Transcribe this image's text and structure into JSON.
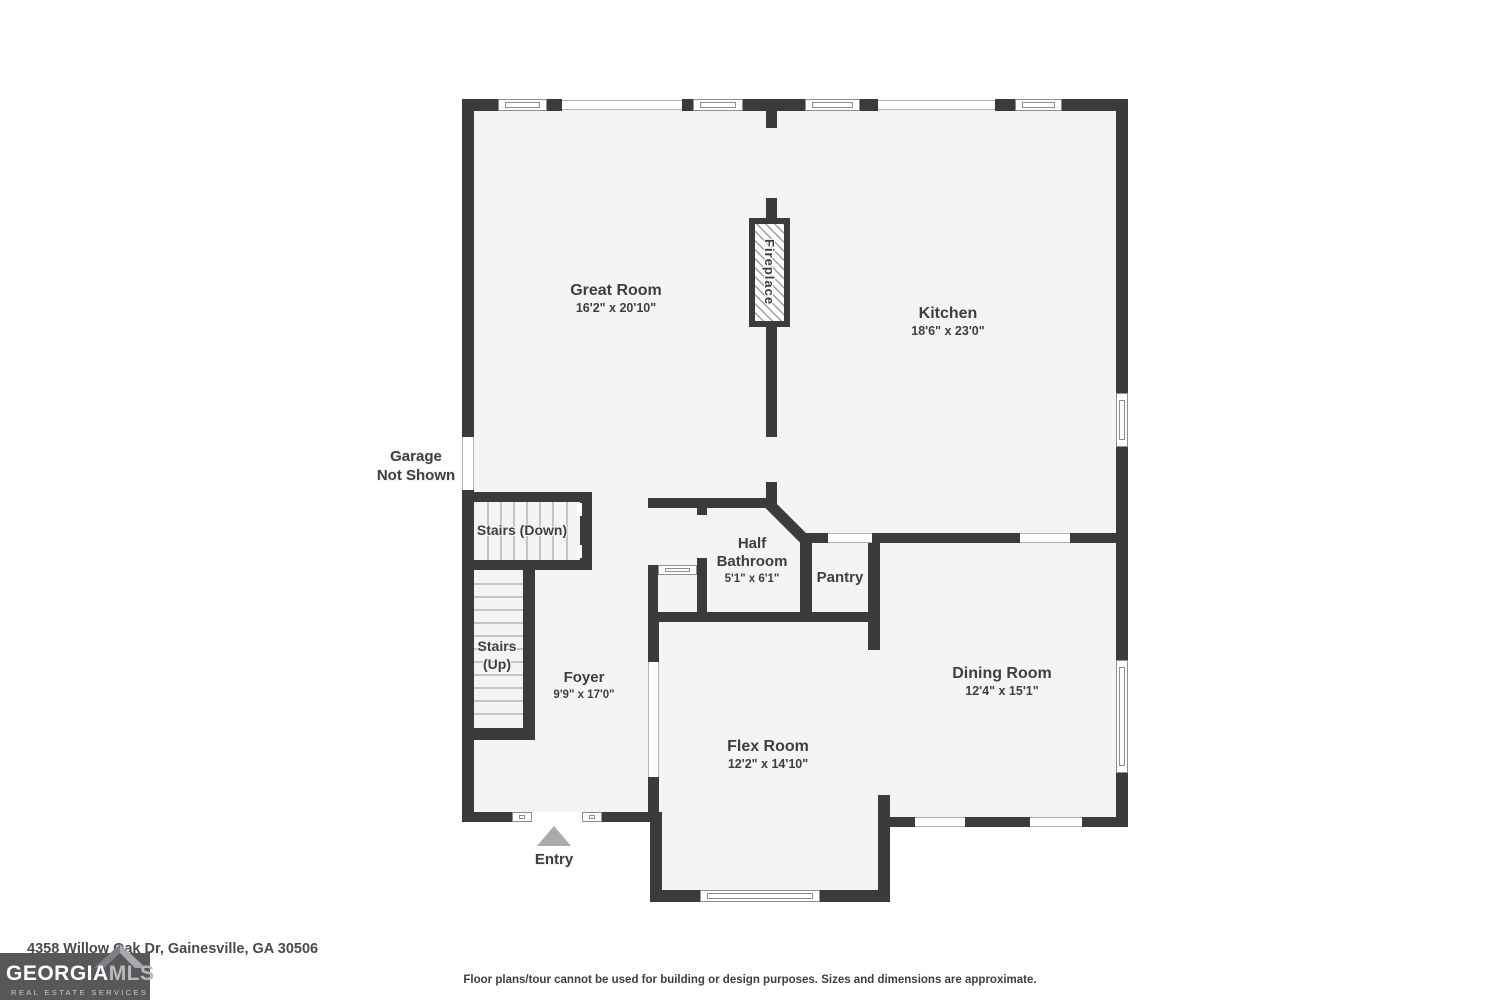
{
  "address": "4358 Willow Oak Dr, Gainesville, GA 30506",
  "disclaimer": "Floor plans/tour cannot be used for building or design purposes. Sizes and dimensions are approximate.",
  "logo": {
    "brand_primary": "GEORGIA",
    "brand_secondary": "MLS",
    "tagline": "REAL ESTATE SERVICES"
  },
  "rooms": [
    {
      "name": "Great Room",
      "dims": "16'2\" x 20'10\""
    },
    {
      "name": "Kitchen",
      "dims": "18'6\" x 23'0\""
    },
    {
      "name": "Half Bathroom",
      "dims": "5'1\" x 6'1\""
    },
    {
      "name": "Pantry",
      "dims": ""
    },
    {
      "name": "Dining Room",
      "dims": "12'4\" x 15'1\""
    },
    {
      "name": "Flex Room",
      "dims": "12'2\" x 14'10\""
    },
    {
      "name": "Foyer",
      "dims": "9'9\" x 17'0\""
    }
  ],
  "annotations": {
    "fireplace": "Fireplace",
    "garage_line1": "Garage",
    "garage_line2": "Not Shown",
    "stairs_down": "Stairs (Down)",
    "stairs_up": "Stairs (Up)",
    "entry": "Entry"
  },
  "colors": {
    "wall": "#3b3b3b",
    "floor": "#f4f4f4",
    "label_text": "#3f3f3f",
    "entry_arrow": "#ababab",
    "logo_background": "#58585a"
  }
}
